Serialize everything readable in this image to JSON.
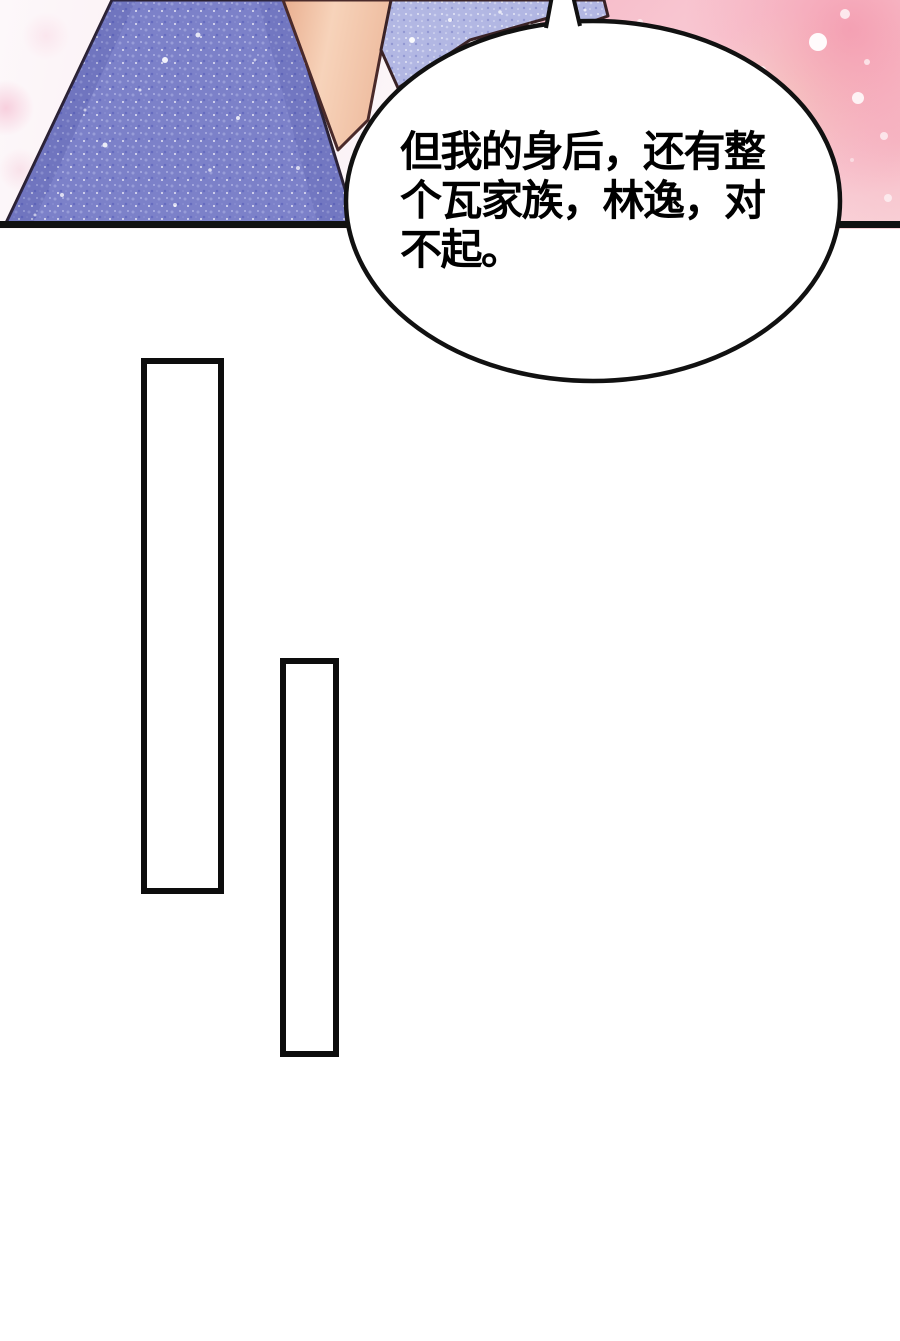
{
  "page": {
    "kind": "comic-panel-page",
    "background": "#ffffff"
  },
  "speech_bubble": {
    "text": "但我的身后，还有整\n个瓦家族，林逸，对\n不起。",
    "fill": "#ffffff",
    "stroke": "#111111"
  },
  "colors": {
    "dress_base": "#7c81c9",
    "dress_speckle": "#989dd8",
    "strip_base": "#b2b7e3",
    "skin_light": "#f7d3ba",
    "skin_dark": "#e9ae8f",
    "pink_background": "#f8c3cf",
    "panel_line": "#111111",
    "bar_border": "#0d0d0d",
    "outline_maroon": "#4a2a2a"
  },
  "shapes": {
    "divider_bar_count": "2"
  }
}
